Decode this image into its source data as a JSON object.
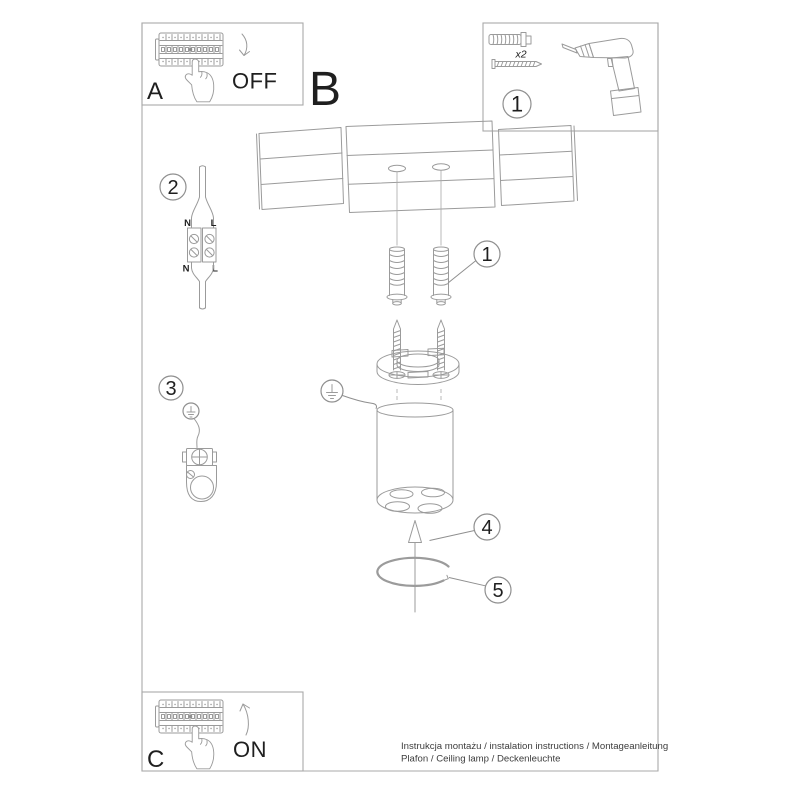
{
  "steps": {
    "a": {
      "label": "A",
      "action": "OFF"
    },
    "b": {
      "label": "B"
    },
    "c": {
      "label": "C",
      "action": "ON"
    }
  },
  "tools_box": {
    "callout": "1",
    "quantity": "x2"
  },
  "callouts": {
    "c1": "1",
    "c2": "2",
    "c3": "3",
    "c4": "4",
    "c5": "5"
  },
  "wiring": {
    "neutral_top": "N",
    "live_top": "L",
    "neutral_bottom": "N",
    "live_bottom": "L"
  },
  "footer": {
    "line1": "Instrukcja montażu / instalation instructions / Montageanleitung",
    "line2": "Plafon / Ceiling lamp / Deckenleuchte"
  },
  "colors": {
    "line": "#9b9b9b",
    "frame": "#a9a9a9",
    "text": "#1f1f1f",
    "footer_text": "#3d3d3d",
    "background": "#ffffff"
  }
}
